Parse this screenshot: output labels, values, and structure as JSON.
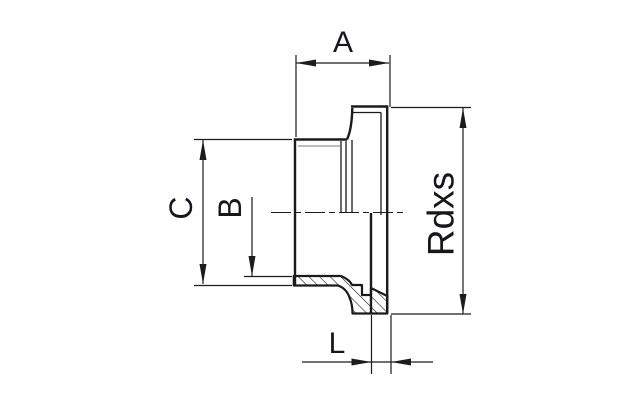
{
  "drawing": {
    "background": "#ffffff",
    "line_color": "#1a1a1a",
    "labels": {
      "dim_a": "A",
      "dim_c": "C",
      "dim_b": "B",
      "thread": "Rdxs",
      "dim_l": "L"
    }
  }
}
